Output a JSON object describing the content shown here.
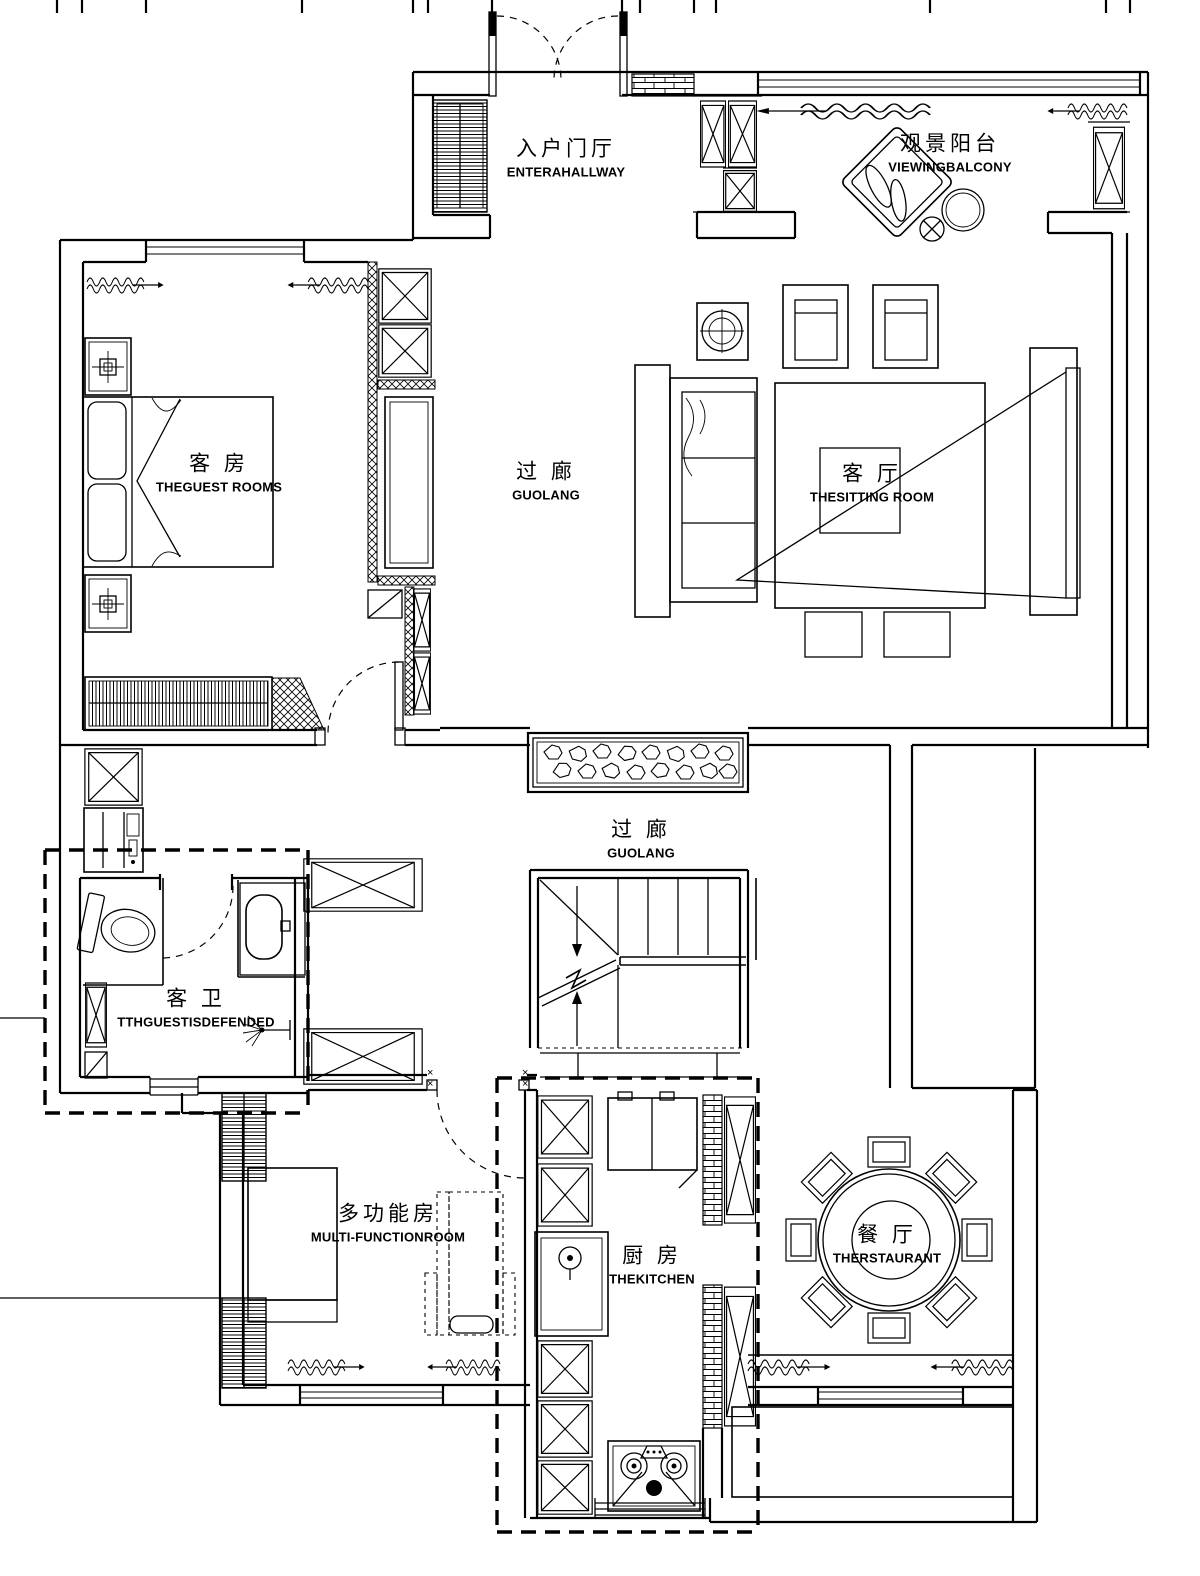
{
  "canvas": {
    "width": 1200,
    "height": 1576,
    "background": "#ffffff",
    "ink": "#000000"
  },
  "plan_type": "residential floor plan (CAD line drawing)",
  "rooms": [
    {
      "id": "entrance-hall",
      "zh": "入户门厅",
      "en": "ENTERAHALLWAY"
    },
    {
      "id": "viewing-balcony",
      "zh": "观景阳台",
      "en": "VIEWINGBALCONY"
    },
    {
      "id": "guest-room",
      "zh": "客 房",
      "en": "THEGUEST ROOMS"
    },
    {
      "id": "corridor-upper",
      "zh": "过 廊",
      "en": "GUOLANG"
    },
    {
      "id": "sitting-room",
      "zh": "客 厅",
      "en": "THESITTING ROOM"
    },
    {
      "id": "corridor-lower",
      "zh": "过 廊",
      "en": "GUOLANG"
    },
    {
      "id": "guest-bathroom",
      "zh": "客 卫",
      "en": "TTHGUESTISDEFENDED"
    },
    {
      "id": "multi-function-room",
      "zh": "多功能房",
      "en": "MULTI-FUNCTIONROOM"
    },
    {
      "id": "kitchen",
      "zh": "厨 房",
      "en": "THEKITCHEN"
    },
    {
      "id": "dining-room",
      "zh": "餐 厅",
      "en": "THERSTAURANT"
    }
  ],
  "annotations": {
    "cross": "×"
  }
}
